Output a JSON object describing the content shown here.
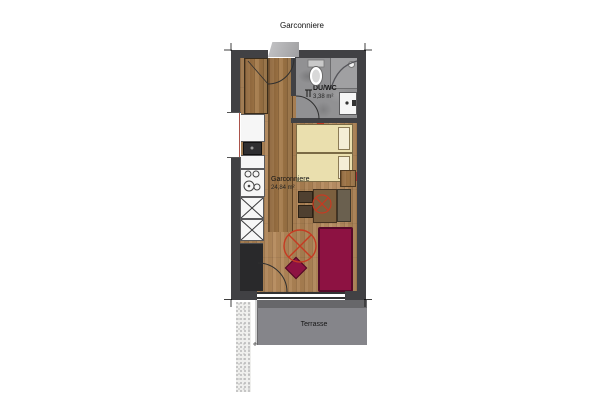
{
  "title": "Garconniere",
  "rooms": {
    "bathroom": {
      "name": "DU/WC",
      "area": "3,38 m²"
    },
    "main": {
      "name": "Garconniere",
      "area": "24,84 m²"
    },
    "terrace": {
      "name": "Terrasse"
    }
  },
  "legend_icons": [
    "ceiling-light-icon",
    "door-swing-icon",
    "threshold-icon"
  ],
  "colors": {
    "wall": "#414144",
    "bath": "#919193",
    "terrace": "#85858a",
    "sofa": "#8d1242",
    "bed": "#eadfae",
    "pillow": "#f4edd6",
    "accent": "#c63a22",
    "woodBase": "#ad8357"
  }
}
